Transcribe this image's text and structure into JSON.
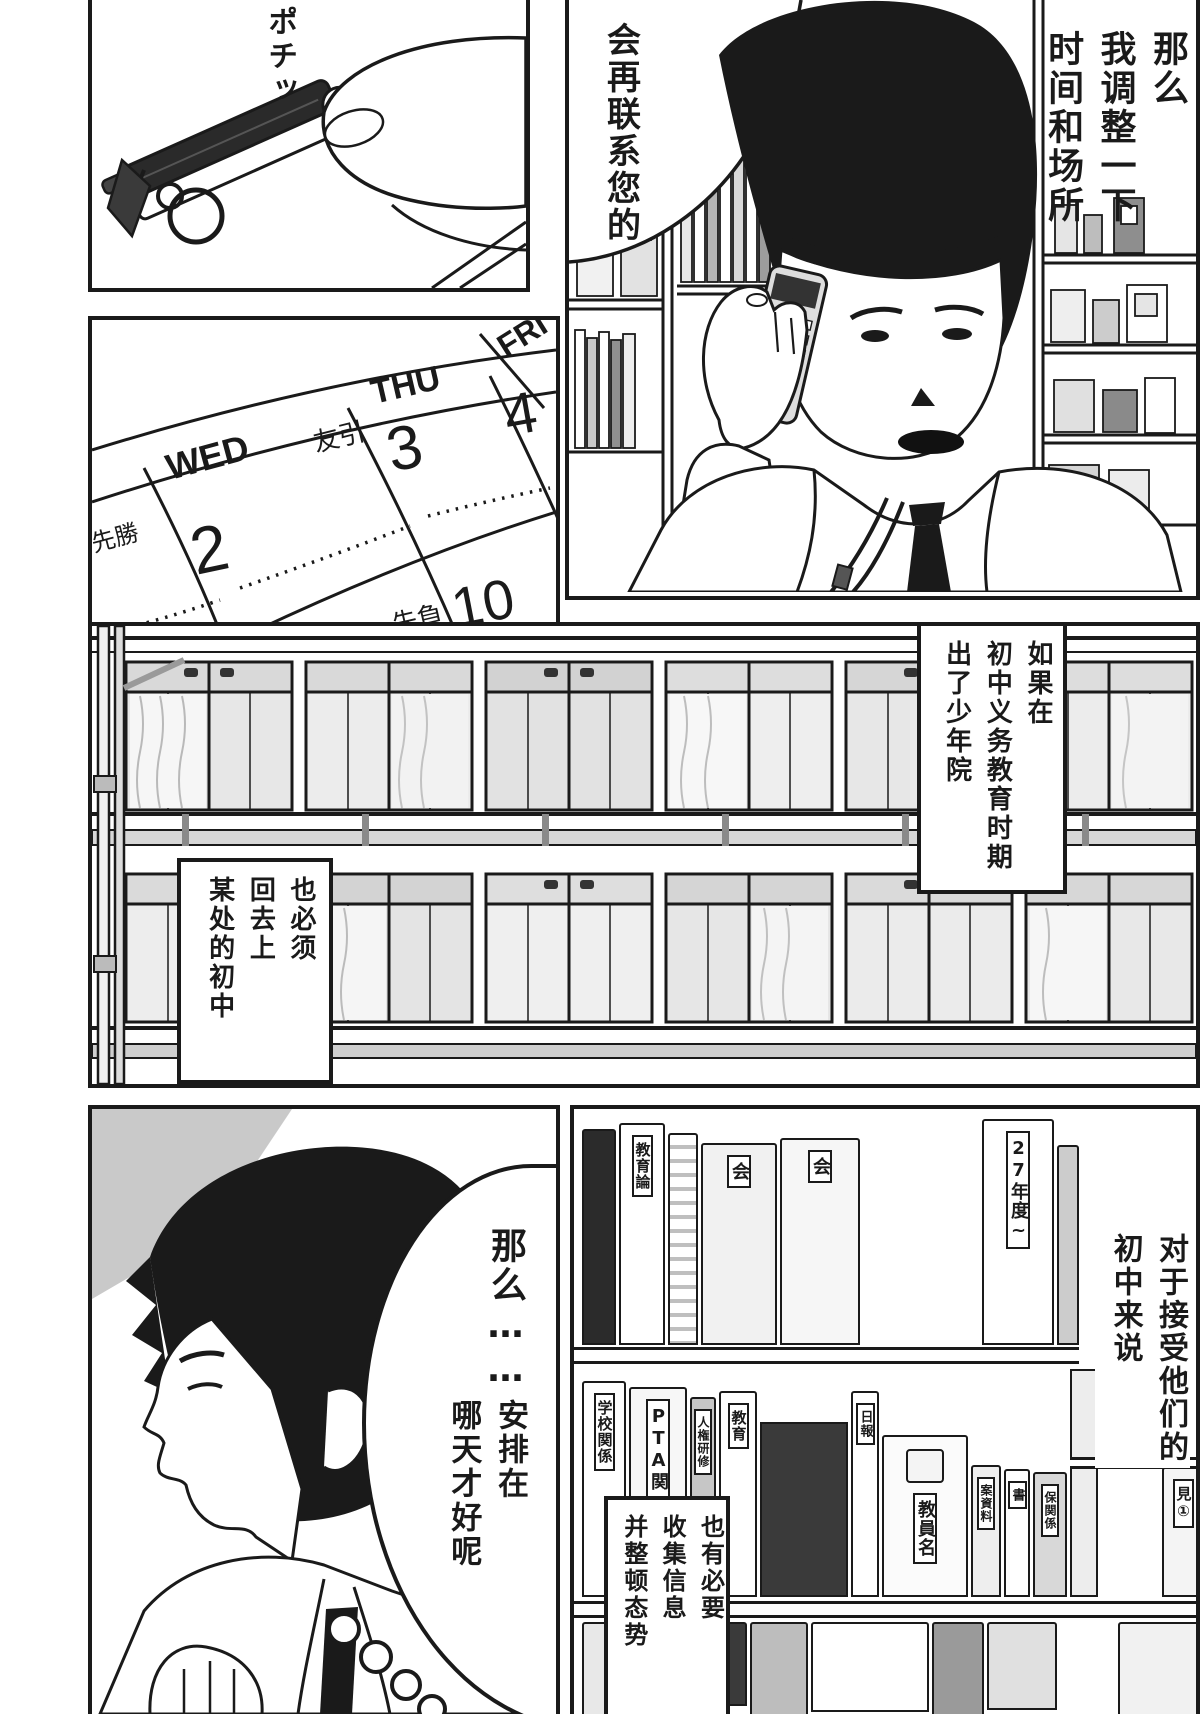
{
  "page": {
    "ink": "#1a1a1a",
    "paper": "#ffffff"
  },
  "panel_phone_hand": {
    "sfx_vertical": "ポチッ"
  },
  "panel_calendar": {
    "col_wed": {
      "dow": "WED",
      "rokuyo": "先勝",
      "date": "2"
    },
    "col_thu": {
      "dow": "THU",
      "rokuyo": "友引",
      "date": "3"
    },
    "col_fri": {
      "dow": "FRI",
      "date": "4"
    },
    "row2": {
      "rokuyo": "先負",
      "date": "10"
    }
  },
  "panel_doctor_call": {
    "speech_right_col1": "那么",
    "speech_right_col2": "我调整一下",
    "speech_right_col3": "时间和场所",
    "speech_left": "会再联系您的"
  },
  "panel_school": {
    "caption_right_col1": "如果在",
    "caption_right_col2": "初中义务教育时期",
    "caption_right_col3": "出了少年院",
    "caption_left_col1": "也必须",
    "caption_left_col2": "回去上",
    "caption_left_col3": "某处的初中"
  },
  "panel_thinking": {
    "speech_line1": "那么……",
    "speech_line2_col1": "安排在",
    "speech_line2_col2": "哪天才好呢"
  },
  "panel_bookshelf": {
    "caption_right_col1": "对于接受他们的",
    "caption_right_col2": "初中来说",
    "caption_bottom_col1": "也有必要",
    "caption_bottom_col2": "收集信息",
    "caption_bottom_col3": "并整顿态势",
    "spines_top": [
      "教育論",
      "会",
      "会",
      "27年度~"
    ],
    "spines_bottom": [
      "学校関係",
      "PTA関",
      "人権研修",
      "教育",
      "日報",
      "教員名",
      "案資料",
      "書",
      "保関係",
      "見①"
    ]
  }
}
